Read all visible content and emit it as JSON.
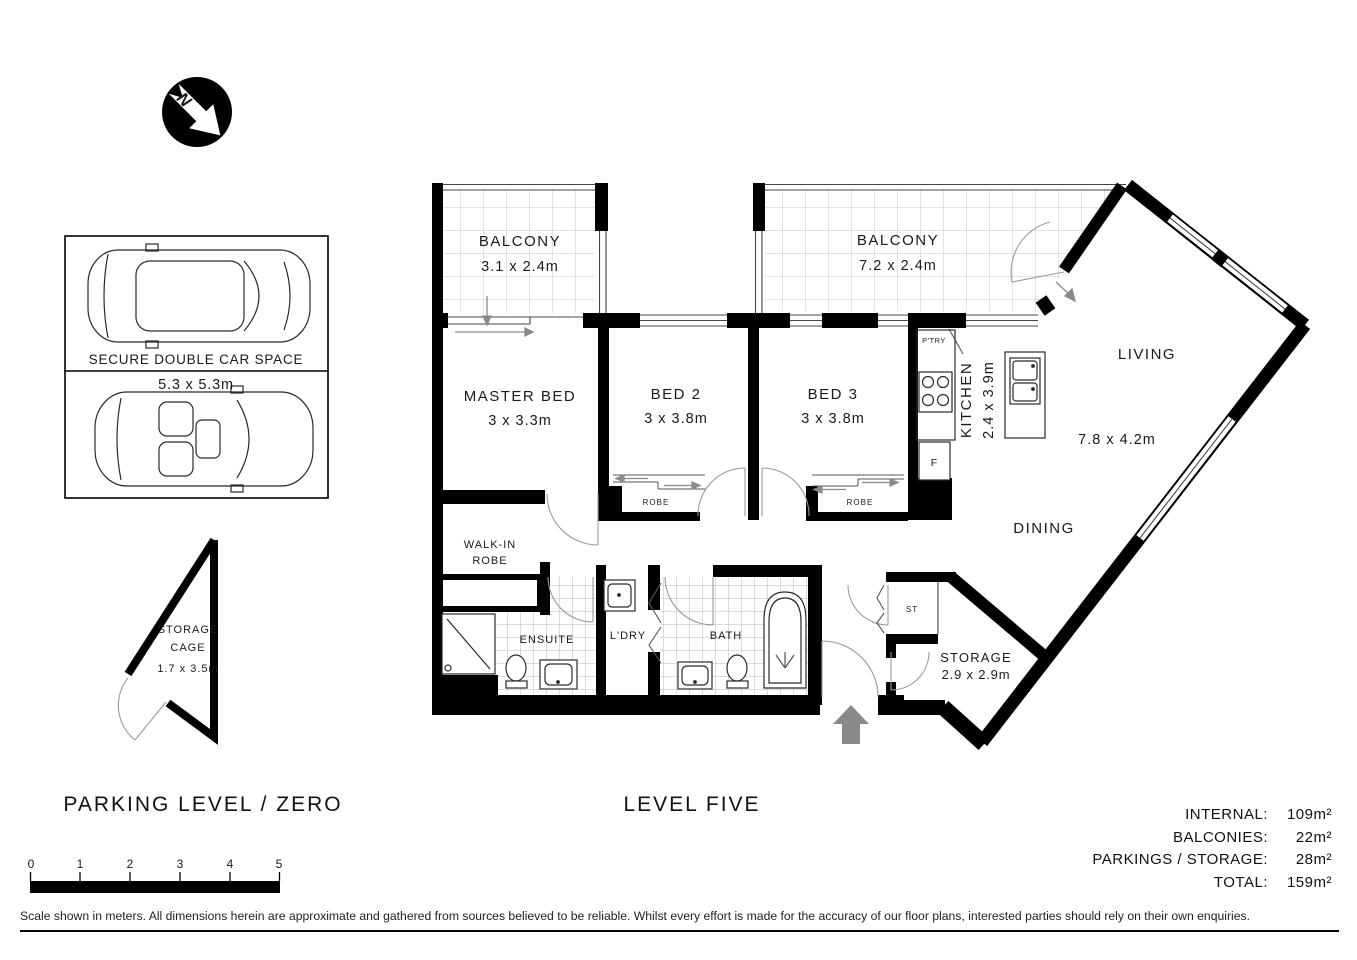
{
  "colors": {
    "wall": "#000000",
    "fixture_line": "#2a2a2a",
    "tile_line": "#c4c4c4",
    "arrow_gray": "#8a8a8a",
    "background": "#ffffff"
  },
  "north_indicator": {
    "label": "N"
  },
  "parking": {
    "level_label": "PARKING LEVEL / ZERO",
    "car_space": {
      "title": "SECURE DOUBLE CAR SPACE",
      "dimensions": "5.3 x 5.3m"
    },
    "storage_cage": {
      "name_line1": "STORAGE",
      "name_line2": "CAGE",
      "dimensions": "1.7 x 3.5m"
    }
  },
  "floorplan": {
    "level_label": "LEVEL FIVE",
    "rooms": {
      "balcony_left": {
        "name": "BALCONY",
        "dimensions": "3.1 x 2.4m"
      },
      "balcony_right": {
        "name": "BALCONY",
        "dimensions": "7.2 x 2.4m"
      },
      "master_bed": {
        "name": "MASTER BED",
        "dimensions": "3 x 3.3m"
      },
      "bed2": {
        "name": "BED 2",
        "dimensions": "3 x 3.8m"
      },
      "bed3": {
        "name": "BED 3",
        "dimensions": "3 x 3.8m"
      },
      "kitchen": {
        "name": "KITCHEN",
        "dimensions": "2.4 x 3.9m"
      },
      "living": {
        "name": "LIVING",
        "dimensions": "7.8 x 4.2m"
      },
      "dining": {
        "name": "DINING"
      },
      "storage": {
        "name": "STORAGE",
        "dimensions": "2.9 x 2.9m"
      },
      "walk_in_robe": {
        "line1": "WALK-IN",
        "line2": "ROBE"
      },
      "ensuite": {
        "name": "ENSUITE"
      },
      "laundry": {
        "name": "L'DRY"
      },
      "bath": {
        "name": "BATH"
      },
      "robe_bed2": {
        "name": "ROBE"
      },
      "robe_bed3": {
        "name": "ROBE"
      },
      "pantry": {
        "name": "P'TRY"
      },
      "fridge": {
        "name": "F"
      },
      "storage_closet": {
        "name": "ST"
      }
    }
  },
  "scale_bar": {
    "ticks": [
      "0",
      "1",
      "2",
      "3",
      "4",
      "5"
    ]
  },
  "areas": [
    {
      "label": "INTERNAL:",
      "value": "109m²"
    },
    {
      "label": "BALCONIES:",
      "value": "22m²"
    },
    {
      "label": "PARKINGS / STORAGE:",
      "value": "28m²"
    },
    {
      "label": "TOTAL:",
      "value": "159m²"
    }
  ],
  "disclaimer": "Scale shown in meters. All dimensions herein are approximate and gathered from sources believed to be reliable. Whilst every effort is made for the accuracy of our floor plans, interested parties should rely on their own enquiries."
}
